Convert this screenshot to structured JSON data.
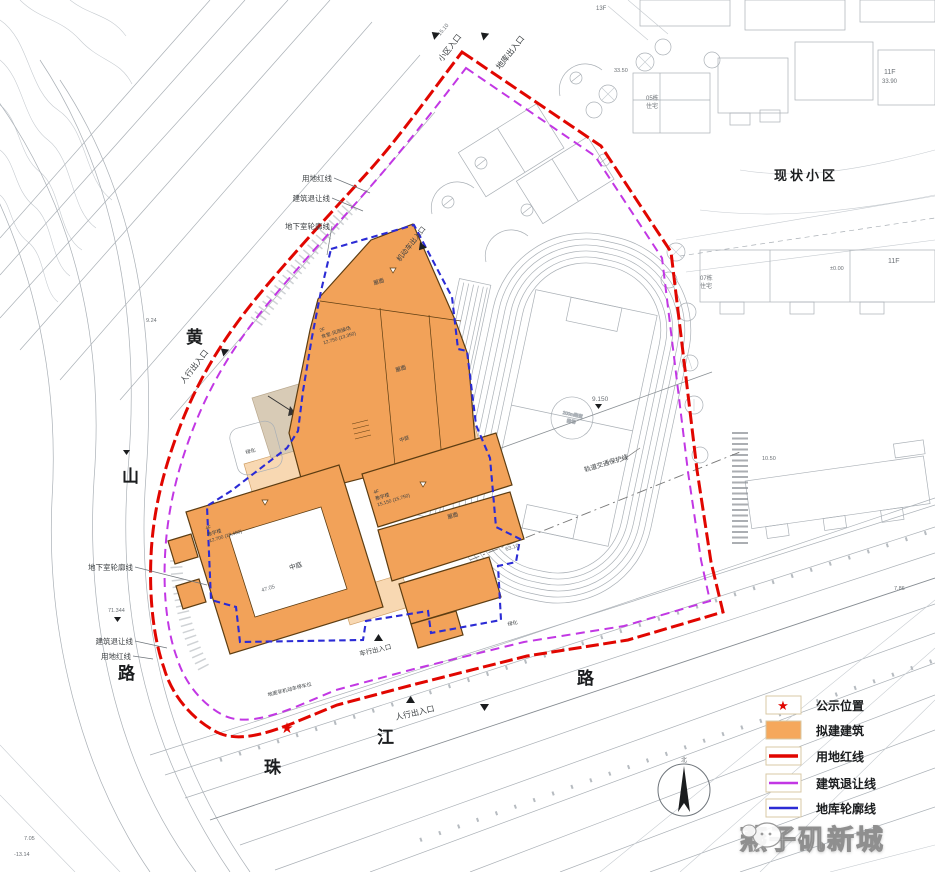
{
  "colors": {
    "building": "#f2a259",
    "building_light": "#f8d8b2",
    "red_line": "#e10600",
    "setback_line": "#c237e4",
    "garage_line": "#2b2bd5",
    "cad_gray": "#aab0b6"
  },
  "roads": {
    "huangshan": [
      "黄",
      "山",
      "路"
    ],
    "zhujiang": [
      "珠",
      "江",
      "路"
    ]
  },
  "labels": {
    "existing_estate": "现状小区",
    "entrance_community": "小区入口",
    "entrance_garage": "地库出入口",
    "entrance_ped_west": "人行出入口",
    "entrance_vehicle_north": "机动车出入口",
    "entrance_ped_south": "人行出入口",
    "entrance_vehicle_south": "车行出入口",
    "red_line_top": "用地红线",
    "setback_top": "建筑退让线",
    "basement_top": "地下室轮廓线",
    "basement_left": "地下室轮廓线",
    "setback_left": "建筑退让线",
    "red_line_left": "用地红线",
    "metro_protect": "轨道交通保护线",
    "bike_parking": "地面非机动车停车位",
    "green1": "绿化",
    "green2": "绿化",
    "roof": "屋面",
    "atrium": "中庭"
  },
  "blocks": {
    "north": [
      "2F",
      "食堂·风雨操场",
      "12.750 (13.350)"
    ],
    "mid": [
      "4F",
      "教学楼",
      "15.150 (15.750)"
    ],
    "ring": [
      "4F",
      "教学楼",
      "12.700 (13.400)"
    ]
  },
  "track": {
    "circle": [
      "200m跑道",
      "操场"
    ]
  },
  "existing": {
    "estate": "现状小区",
    "b05": "05栋",
    "b05u": "住宅",
    "b07": "07栋",
    "b07u": "住宅",
    "f11a": "11F",
    "f11b": "11F",
    "f13": "13F",
    "h1190": "33.90"
  },
  "elev": {
    "e1": "9.150",
    "e2": "71.344",
    "e3": "±0.00",
    "e4": "9.24",
    "e5": "7.05",
    "e6": "-13.14",
    "e7": "47.05",
    "e8": "63.10",
    "e9": "10.50",
    "e10": "7.86",
    "e11": "15.10",
    "e12": "33.50"
  },
  "icons": {
    "star": "★"
  },
  "legend": {
    "items": [
      {
        "label": "公示位置",
        "type": "star"
      },
      {
        "label": "拟建建筑",
        "type": "fill"
      },
      {
        "label": "用地红线",
        "type": "red-line"
      },
      {
        "label": "建筑退让线",
        "type": "purple-line"
      },
      {
        "label": "地库轮廓线",
        "type": "blue-line"
      }
    ]
  },
  "watermark": {
    "name": "燕子矶新城"
  },
  "compass": {
    "north": "北"
  }
}
